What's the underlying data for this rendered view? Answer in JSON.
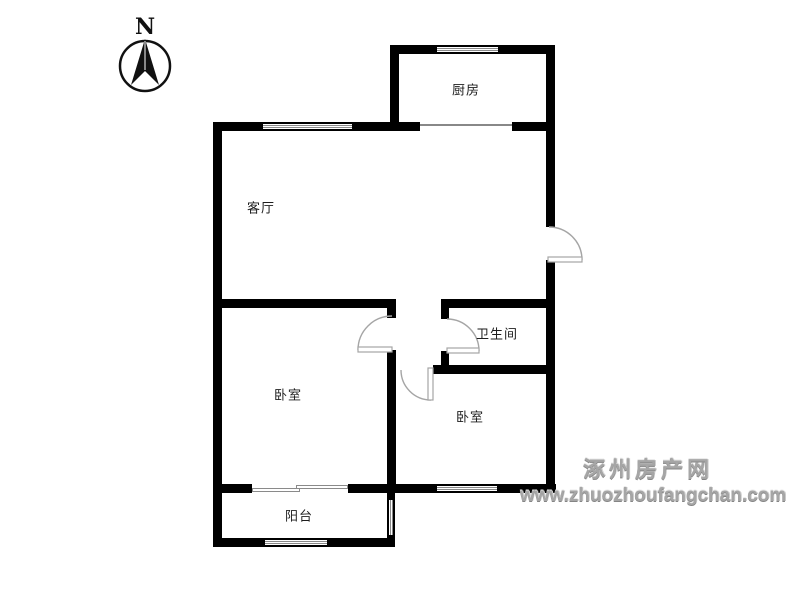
{
  "compass": {
    "north_label": "N"
  },
  "rooms": {
    "kitchen": {
      "label": "厨房"
    },
    "living_room": {
      "label": "客厅"
    },
    "bedroom_left": {
      "label": "卧室"
    },
    "bedroom_right": {
      "label": "卧室"
    },
    "bathroom": {
      "label": "卫生间"
    },
    "balcony": {
      "label": "阳台"
    }
  },
  "watermark": {
    "site_name": "涿州房产网",
    "site_url": "www.zhuozhoufangchan.com"
  },
  "colors": {
    "wall": "#000000",
    "door": "#a5a5a5",
    "label_text": "#1d1d1d",
    "watermark_text": "#a6a6a6"
  }
}
